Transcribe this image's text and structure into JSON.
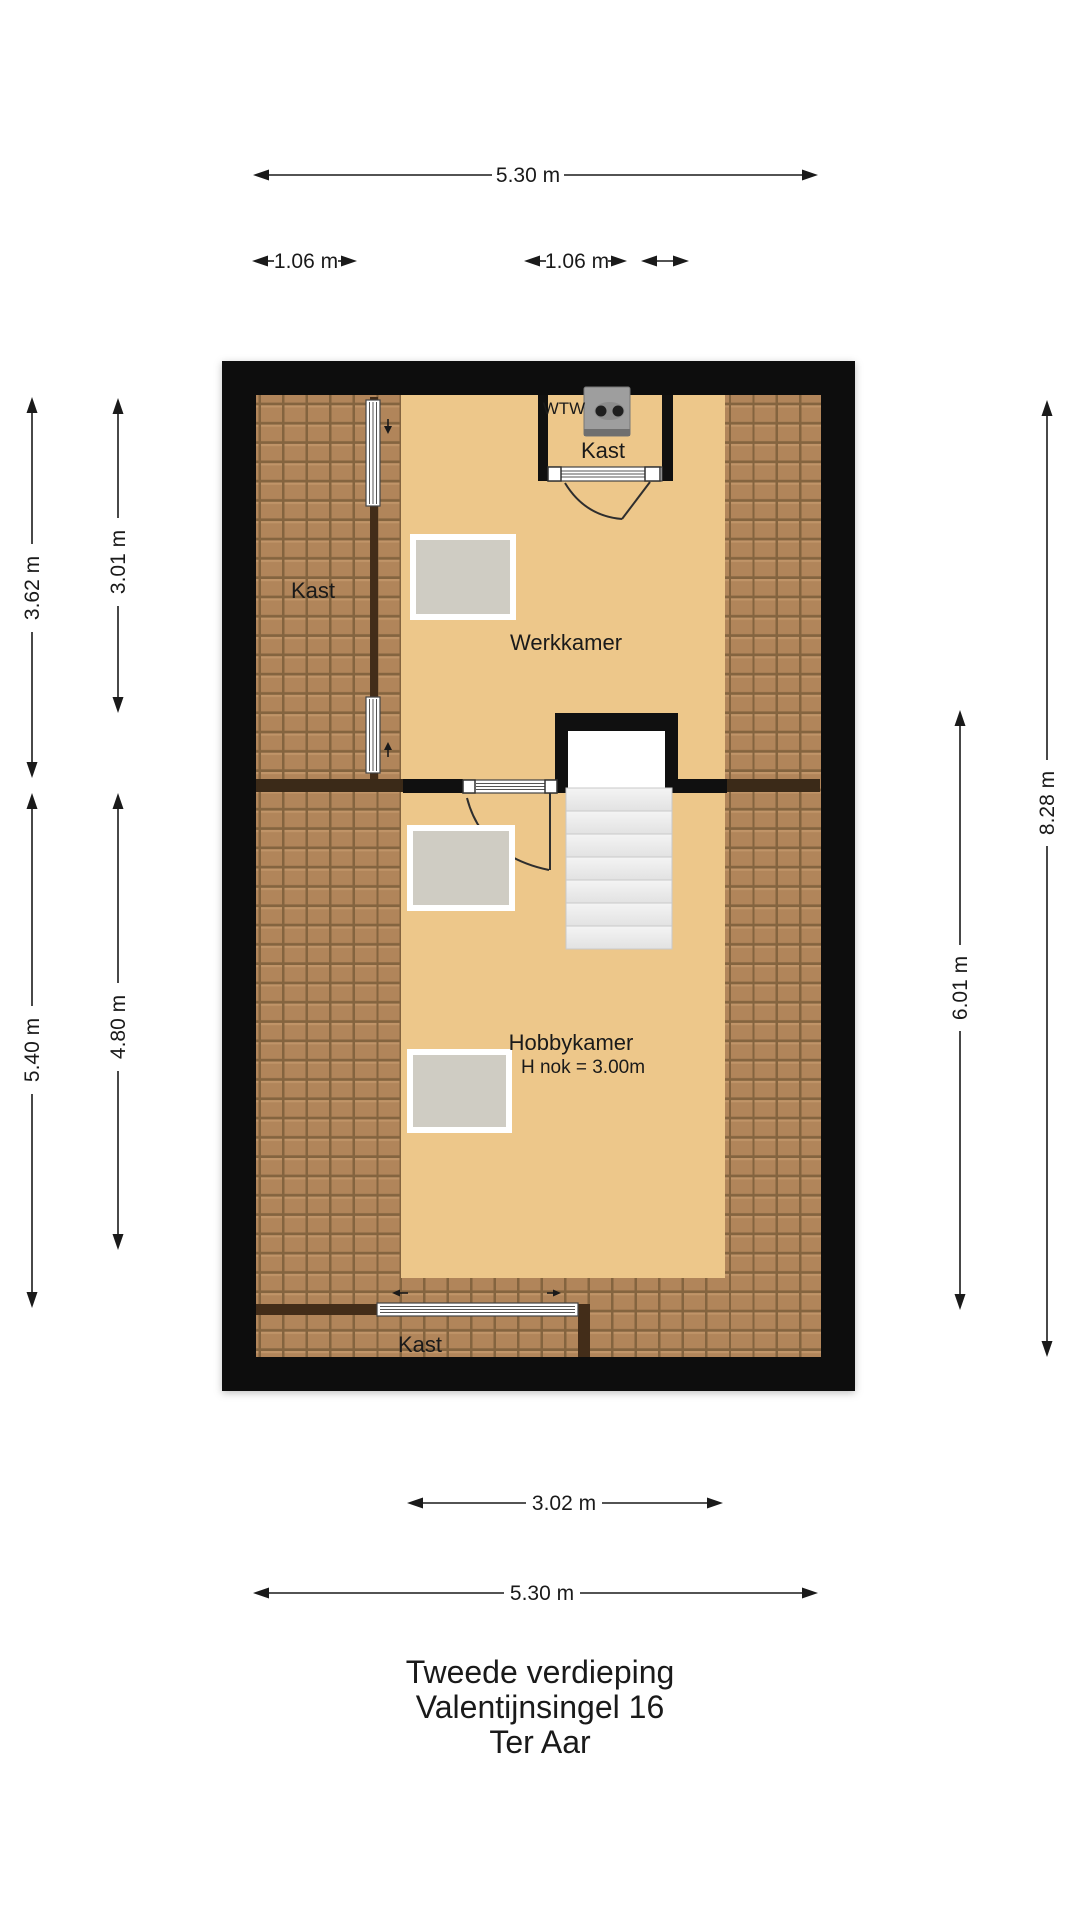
{
  "plan": {
    "labels": {
      "kast_left": "Kast",
      "werkkamer": "Werkkamer",
      "kast_top": "Kast",
      "wtw": "WTW",
      "hobbykamer": "Hobbykamer",
      "hobby_height": "H nok = 3.00m",
      "kast_bottom": "Kast"
    },
    "dimensions": {
      "top_total": "5.30 m",
      "top_left_closet": "1.06 m",
      "top_right_closet": "1.06 m",
      "left_outer_upper": "3.62 m",
      "left_inner_upper": "3.01 m",
      "left_outer_lower": "5.40 m",
      "left_inner_lower": "4.80 m",
      "right_outer": "8.28 m",
      "right_inner": "6.01 m",
      "bottom_inner": "3.02 m",
      "bottom_total": "5.30 m"
    },
    "footer": {
      "line1": "Tweede verdieping",
      "line2": "Valentijnsingel 16",
      "line3": "Ter Aar"
    },
    "colors": {
      "wall": "#101010",
      "floor": "#edc78a",
      "tile_base": "#b1855a",
      "tile_seam": "#84643f",
      "tile_ridge": "#c09468",
      "divider": "#432d19",
      "wall_band": "#3b2a18",
      "desk": "#cfccc3",
      "step": "#e9e9e9",
      "wtw_unit": "#9e9e9e"
    }
  }
}
